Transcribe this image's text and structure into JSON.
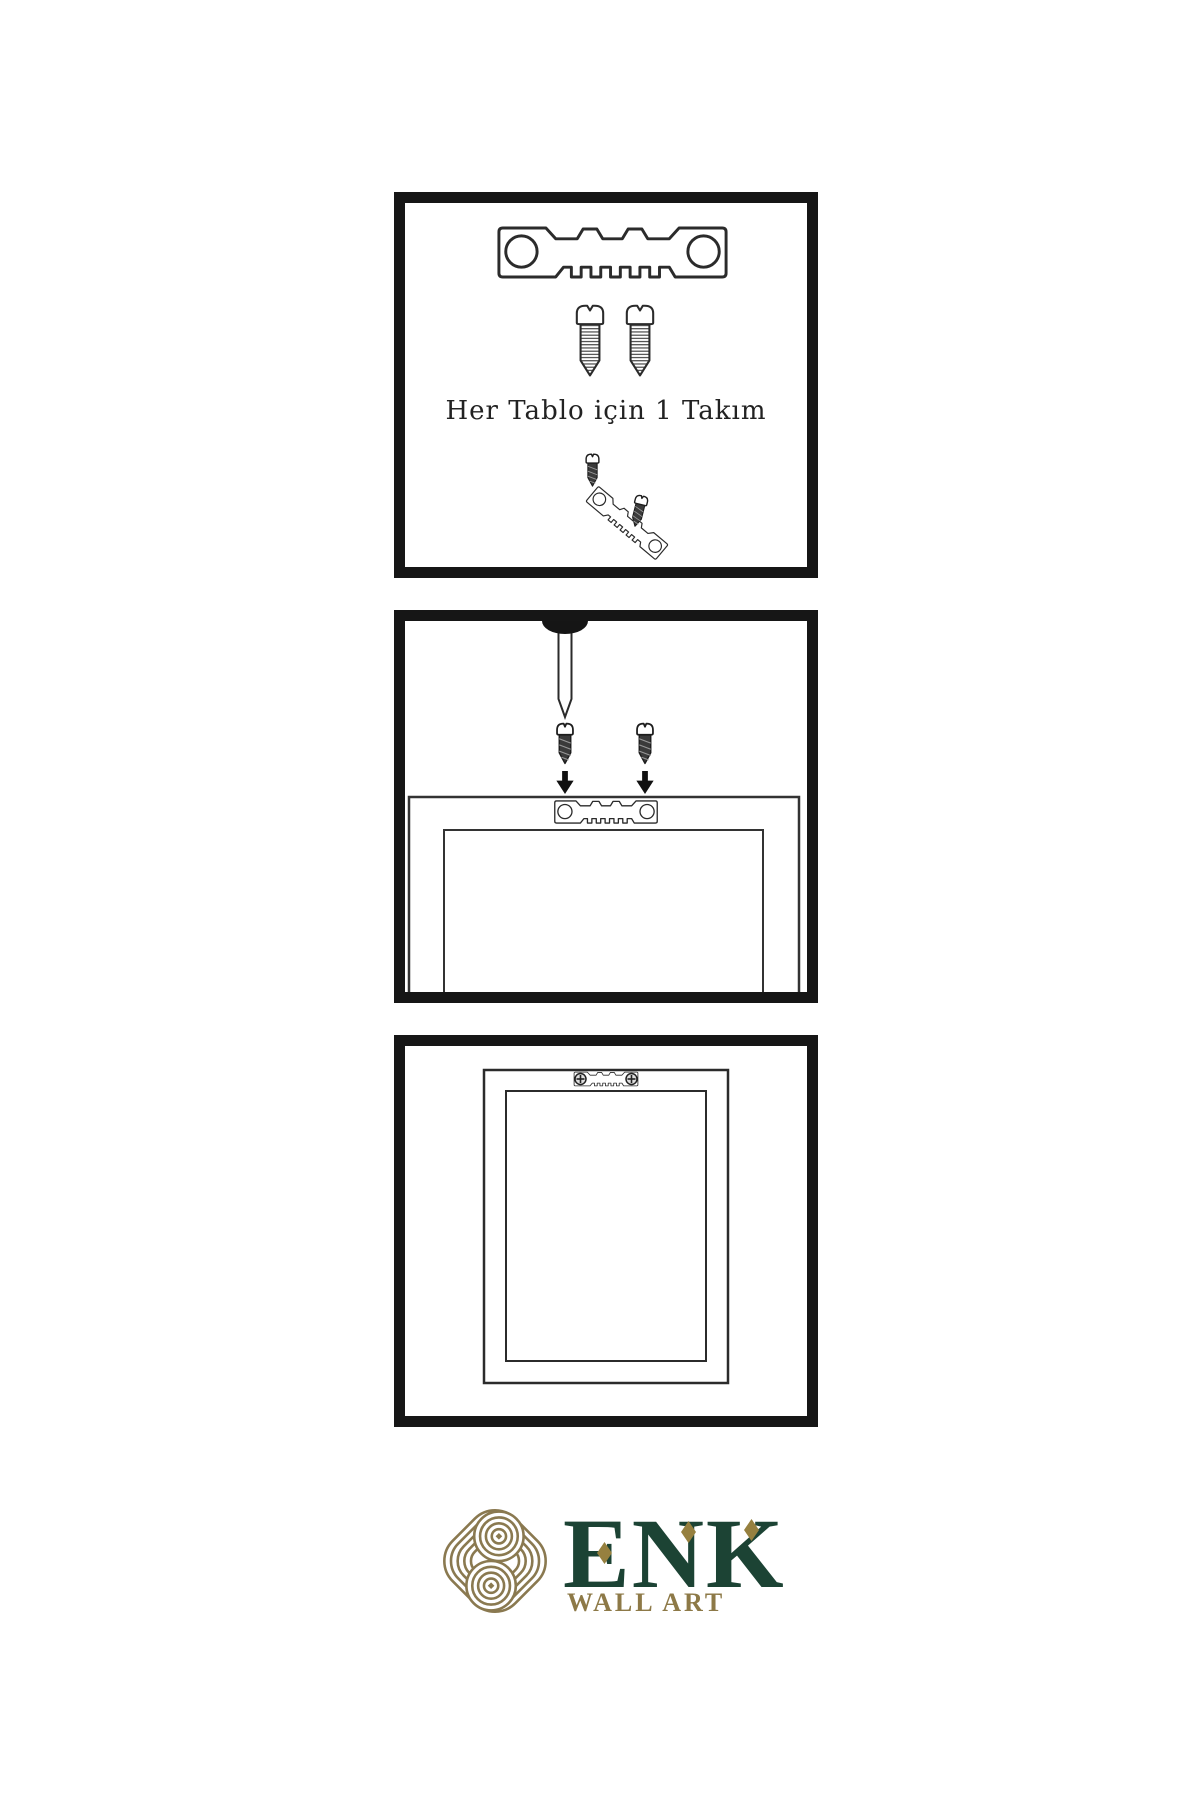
{
  "brand": {
    "name": "ENK",
    "subtitle": "WALL ART"
  },
  "steps": {
    "step1": {
      "caption": "Her Tablo için 1 Takım",
      "icons": [
        "sawtooth-hanger-icon",
        "mounting-screw-icon",
        "mounting-screw-icon",
        "screw-into-hanger-icon"
      ]
    },
    "step2": {
      "icons": [
        "wall-nail-icon",
        "mounting-screw-icon",
        "down-arrow-icon",
        "sawtooth-hanger-icon",
        "frame-back-icon"
      ]
    },
    "step3": {
      "icons": [
        "frame-back-icon",
        "mounted-sawtooth-hanger-icon"
      ]
    }
  },
  "colors": {
    "panel_border": "#161616",
    "line_art": "#2b2b2b",
    "brand_green": "#1c4334",
    "brand_gold": "#8d7947",
    "knot_gold": "#8a7950",
    "diamond_gold": "#96803f"
  }
}
